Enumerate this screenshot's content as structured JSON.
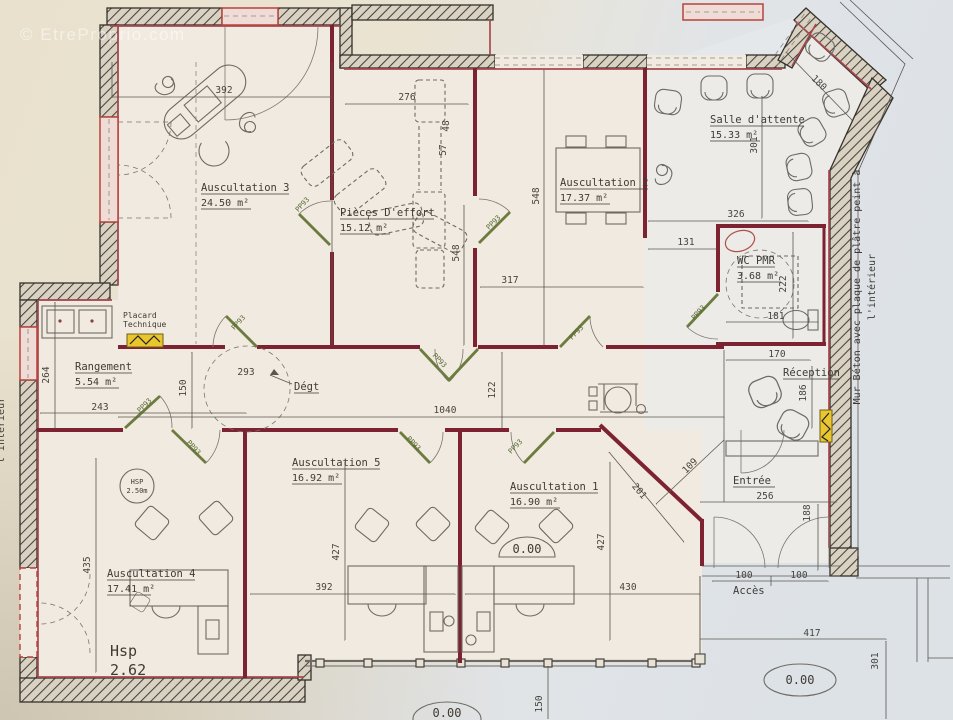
{
  "watermark": "© EtreProprio.com",
  "door_label": "PP93",
  "level_zero": "0.00",
  "rooms": {
    "ausc3": {
      "name": "Auscultation 3",
      "area": "24.50 m²"
    },
    "effort": {
      "name": "Pièces D'effort",
      "area": "15.12 m²"
    },
    "ausc2": {
      "name": "Auscultation 2",
      "area": "17.37 m²"
    },
    "salle": {
      "name": "Salle d'attente",
      "area": "15.33 m²"
    },
    "wc": {
      "name": "WC PMR",
      "area": "3.68 m²"
    },
    "reception": {
      "name": "Réception"
    },
    "rangement": {
      "name": "Rangement",
      "area": "5.54 m²"
    },
    "placard": {
      "line1": "Placard",
      "line2": "Technique"
    },
    "degt": {
      "name": "Dégt"
    },
    "ausc5": {
      "name": "Auscultation 5",
      "area": "16.92 m²"
    },
    "ausc1": {
      "name": "Auscultation 1",
      "area": "16.90 m²"
    },
    "ausc4": {
      "name": "Auscultation 4",
      "area": "17.41 m²"
    },
    "entree": {
      "name": "Entrée"
    },
    "acces": {
      "name": "Accès"
    },
    "hsp": {
      "label": "Hsp",
      "value": "2.62"
    },
    "hsp_circle": {
      "label": "HSP",
      "value": "2.50m"
    }
  },
  "dims": {
    "ausc3_width": "392",
    "effort_width": "276",
    "effort_gap": "48",
    "effort_depth": "57",
    "depth_a": "548",
    "depth_b": "548",
    "ausc2_width": "317",
    "salle_width": "326",
    "salle_height": "301",
    "porch_width": "180",
    "wc_offset": "131",
    "wc_height": "222",
    "wc_width": "181",
    "reception_width": "170",
    "reception_height": "186",
    "rangement_height": "264",
    "rangement_width": "243",
    "degt_width": "150",
    "degt_door": "293",
    "corridor_length": "1040",
    "corridor_offset": "122",
    "ausc4_height": "435",
    "ausc5_height": "427",
    "ausc5_width": "392",
    "ausc1_height": "427",
    "ausc1_width": "430",
    "entree_diag": "201",
    "entree_diag2": "109",
    "entree_width": "256",
    "entree_height": "188",
    "acces_left": "100",
    "acces_right": "100",
    "terrace_width": "417",
    "terrace_height": "301",
    "terrace_offset": "150"
  },
  "annotations": {
    "wall_note_line1": "Mur Béton avec plaque de plâtre peint à",
    "wall_note_line2": "l'intérieur",
    "left_note": "l'intérieur"
  }
}
